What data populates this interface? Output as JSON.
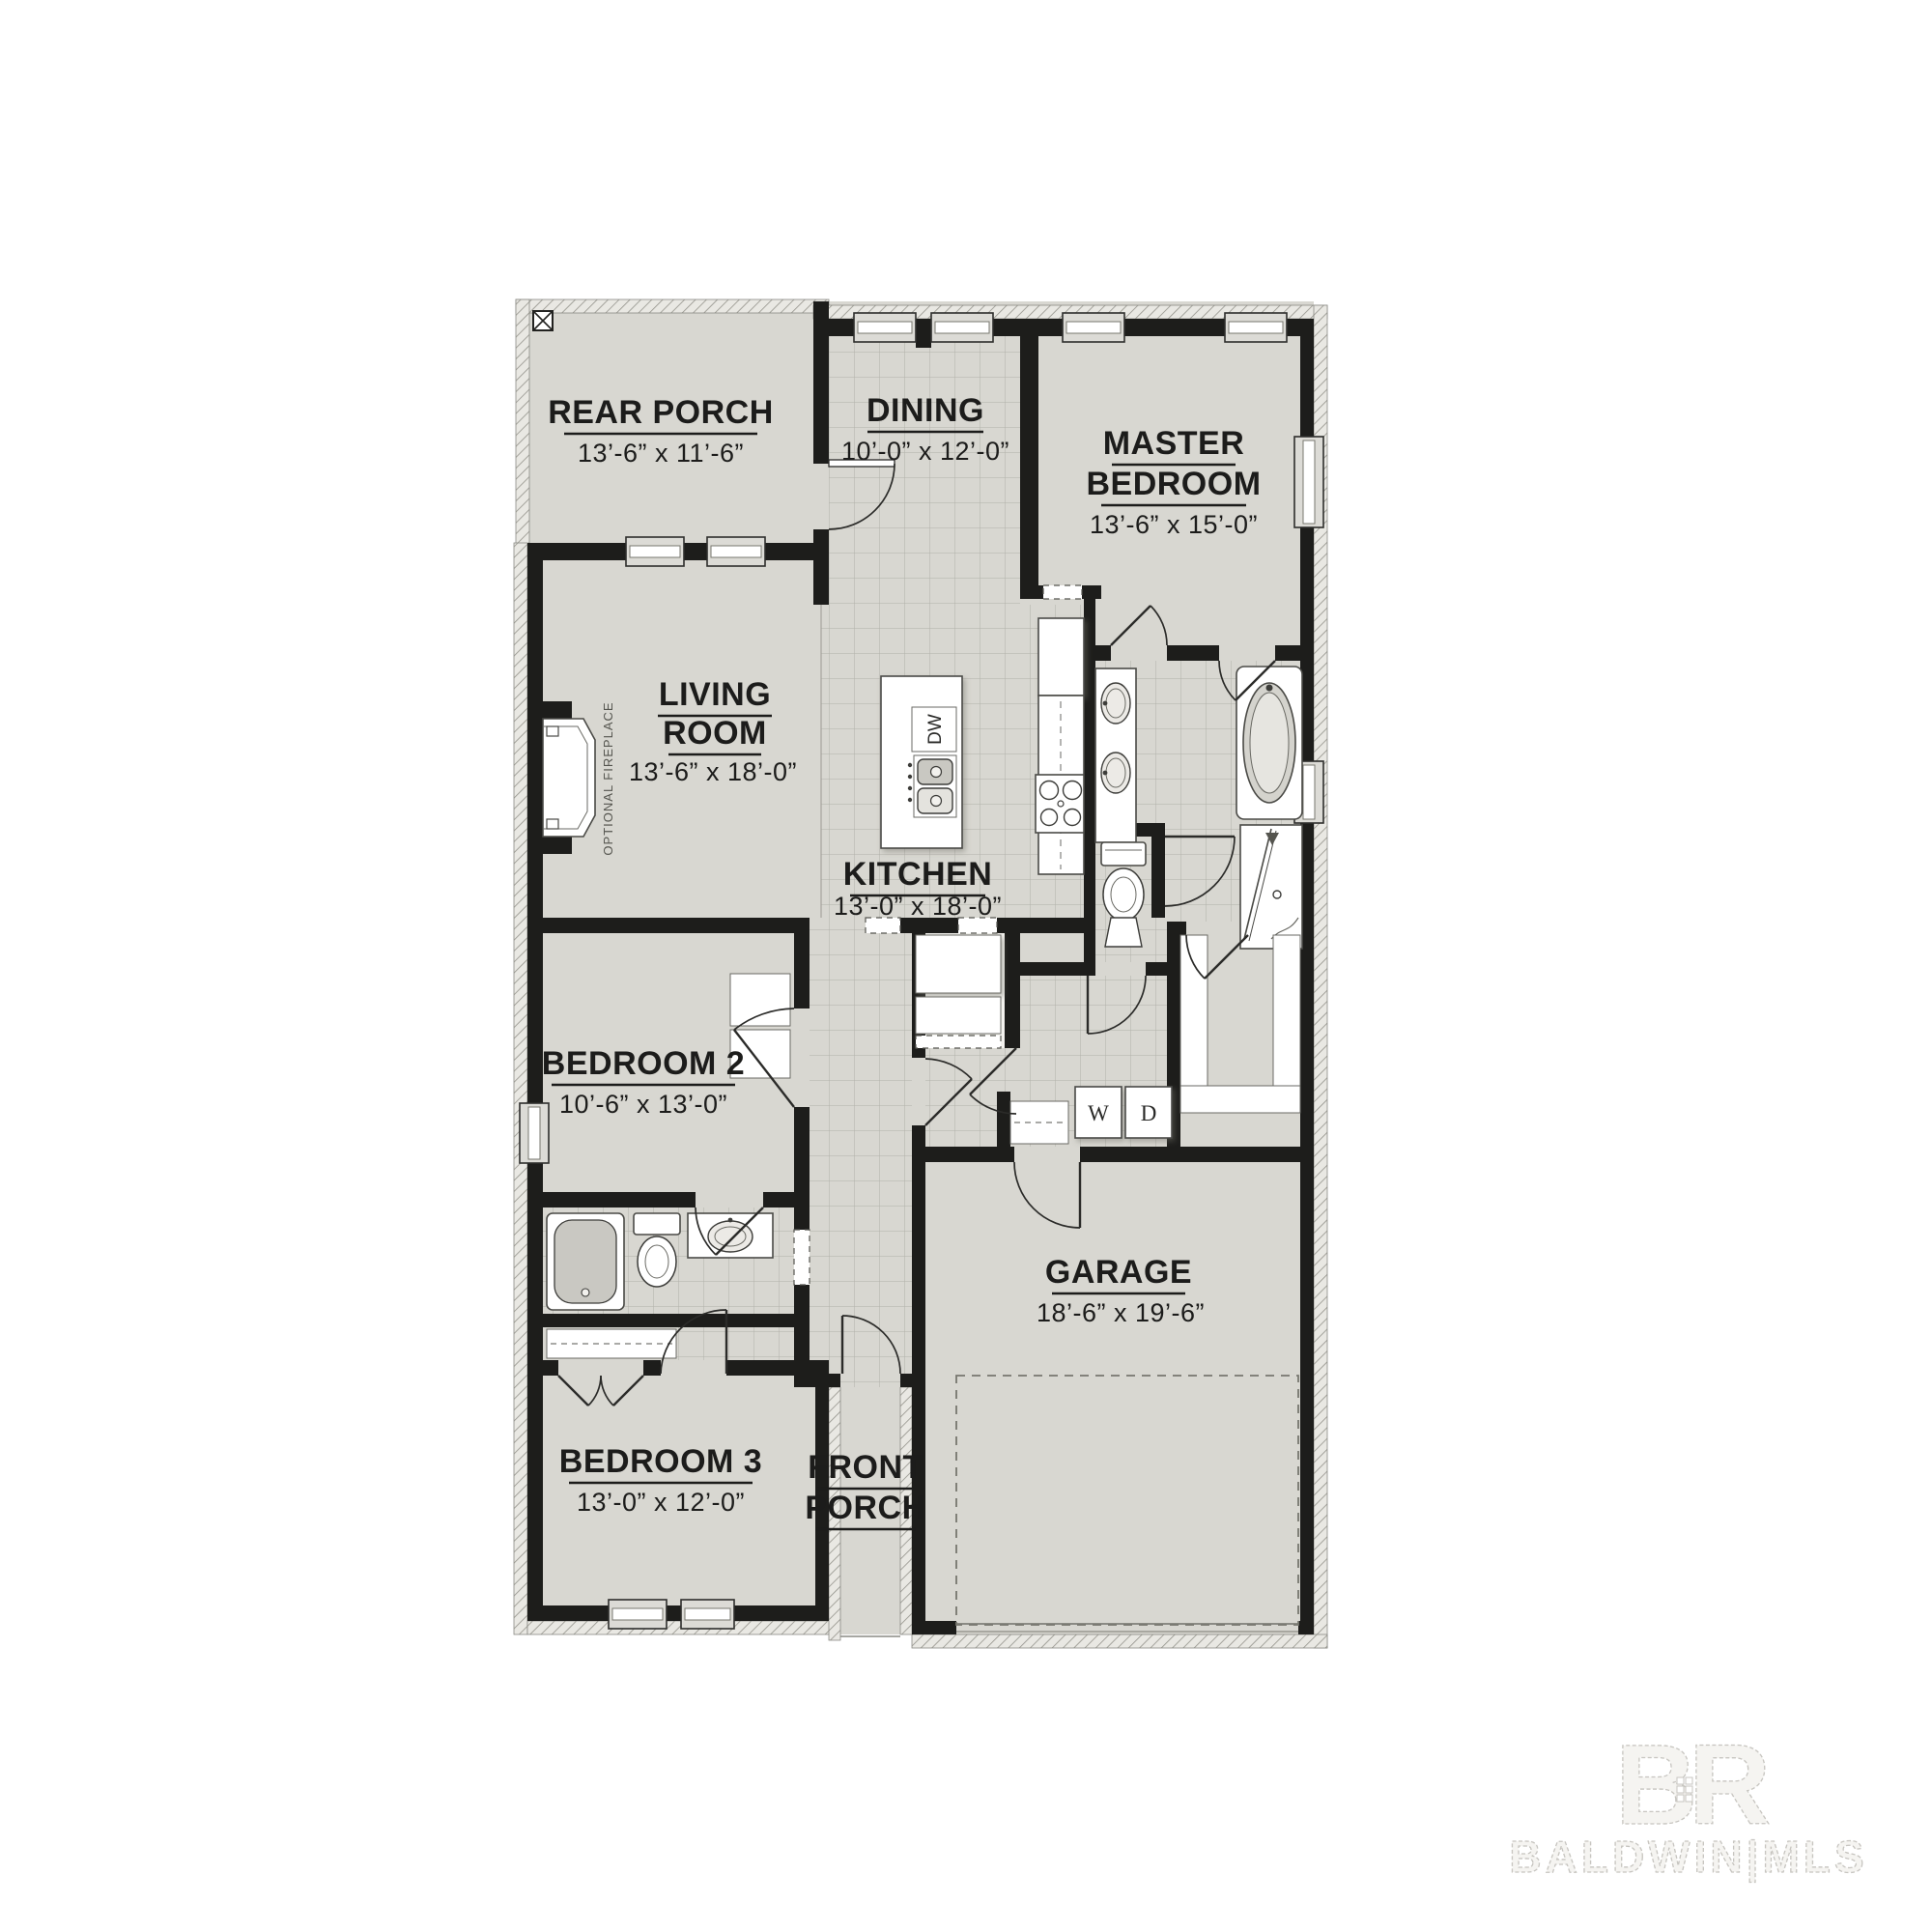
{
  "colors": {
    "background": "#ffffff",
    "wall": "#1d1d1b",
    "floor": "#d8d7d1",
    "tile_line": "#b1b0a9",
    "label": "#1c1c1b",
    "watermark": "#c7c5c0"
  },
  "rooms": [
    {
      "id": "rear-porch",
      "label": "REAR PORCH",
      "dims": "13’-6” x 11’-6”"
    },
    {
      "id": "dining",
      "label": "DINING",
      "dims": "10’-0” x 12’-0”"
    },
    {
      "id": "master-bedroom",
      "line1": "MASTER",
      "line2": "BEDROOM",
      "dims": "13’-6” x 15’-0”"
    },
    {
      "id": "living-room",
      "line1": "LIVING",
      "line2": "ROOM",
      "dims": "13’-6” x 18’-0”"
    },
    {
      "id": "kitchen",
      "label": "KITCHEN",
      "dims": "13’-0” x 18’-0”"
    },
    {
      "id": "bedroom-2",
      "label": "BEDROOM 2",
      "dims": "10’-6” x 13’-0”"
    },
    {
      "id": "bedroom-3",
      "label": "BEDROOM 3",
      "dims": "13’-0” x 12’-0”"
    },
    {
      "id": "garage",
      "label": "GARAGE",
      "dims": "18’-6” x 19’-6”"
    },
    {
      "id": "front-porch",
      "line1": "FRONT",
      "line2": "PORCH"
    }
  ],
  "fixtures": {
    "dishwasher": "DW",
    "washer": "W",
    "dryer": "D",
    "fireplace_note": "OPTIONAL FIREPLACE"
  },
  "watermark": {
    "logo_b": "B",
    "logo_r": "R",
    "label": "BALDWIN|MLS"
  }
}
